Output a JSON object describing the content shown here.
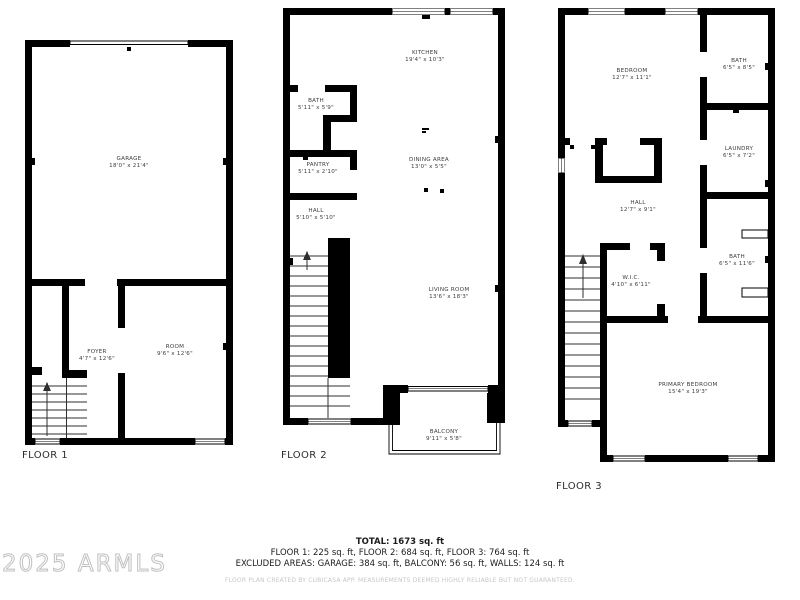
{
  "watermark": "2025 ARMLS",
  "floors": [
    {
      "label": "FLOOR 1",
      "rooms": [
        {
          "name": "GARAGE",
          "dims": "18'0\" x 21'4\""
        },
        {
          "name": "FOYER",
          "dims": "4'7\" x 12'6\""
        },
        {
          "name": "ROOM",
          "dims": "9'6\" x 12'6\""
        }
      ]
    },
    {
      "label": "FLOOR 2",
      "rooms": [
        {
          "name": "KITCHEN",
          "dims": "19'4\" x 10'3\""
        },
        {
          "name": "BATH",
          "dims": "5'11\" x 5'9\""
        },
        {
          "name": "PANTRY",
          "dims": "5'11\" x 2'10\""
        },
        {
          "name": "HALL",
          "dims": "5'10\" x 5'10\""
        },
        {
          "name": "DINING AREA",
          "dims": "13'0\" x 5'5\""
        },
        {
          "name": "LIVING ROOM",
          "dims": "13'6\" x 18'3\""
        },
        {
          "name": "BALCONY",
          "dims": "9'11\" x 5'8\""
        }
      ]
    },
    {
      "label": "FLOOR 3",
      "rooms": [
        {
          "name": "BEDROOM",
          "dims": "12'7\" x 11'1\""
        },
        {
          "name": "BATH",
          "dims": "6'5\" x 8'5\""
        },
        {
          "name": "LAUNDRY",
          "dims": "6'5\" x 7'2\""
        },
        {
          "name": "HALL",
          "dims": "12'7\" x 9'1\""
        },
        {
          "name": "W.I.C.",
          "dims": "4'10\" x 6'11\""
        },
        {
          "name": "BATH",
          "dims": "6'5\" x 11'6\""
        },
        {
          "name": "PRIMARY BEDROOM",
          "dims": "15'4\" x 19'3\""
        }
      ]
    }
  ],
  "summary": {
    "total": "TOTAL: 1673 sq. ft",
    "floors_line": "FLOOR 1: 225 sq. ft, FLOOR 2: 684 sq. ft, FLOOR 3: 764 sq. ft",
    "excluded_line": "EXCLUDED AREAS: GARAGE: 384 sq. ft, BALCONY: 56 sq. ft, WALLS: 124 sq. ft",
    "disclaimer": "FLOOR PLAN CREATED BY CUBICASA APP. MEASUREMENTS DEEMED HIGHLY RELIABLE BUT NOT GUARANTEED."
  }
}
